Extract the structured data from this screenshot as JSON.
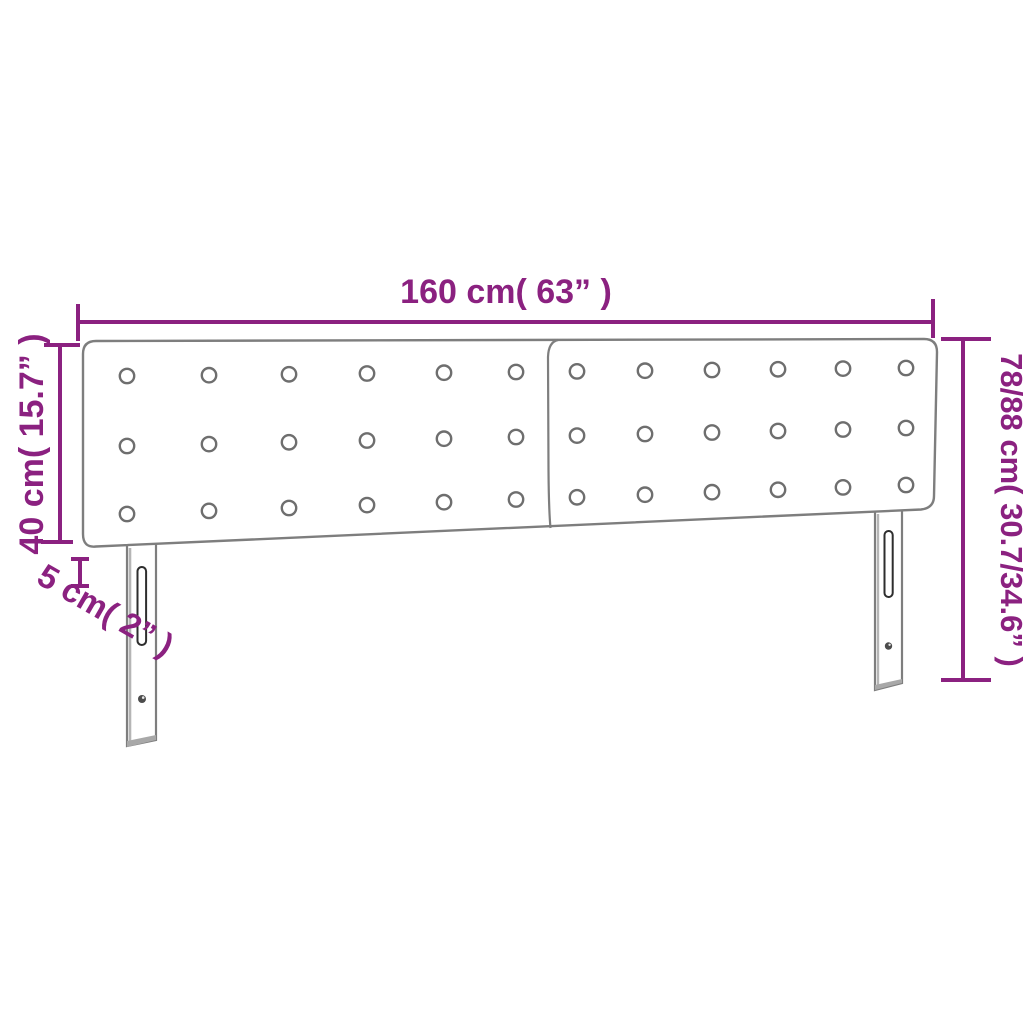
{
  "diagram": {
    "kind": "product-dimension-diagram",
    "colors": {
      "accent": "#8B2180",
      "outline": "#7E7E7E"
    },
    "dimensions": {
      "width_label": "160 cm( 63” )",
      "panel_height_label": "40 cm( 15.7” )",
      "thickness_label": "5 cm( 2” )",
      "total_height_label": "78/88 cm( 30.7/34.6” )"
    },
    "headboard": {
      "panels": 2,
      "button_rows": 3,
      "button_cols_per_panel": 6,
      "legs": 2
    }
  }
}
